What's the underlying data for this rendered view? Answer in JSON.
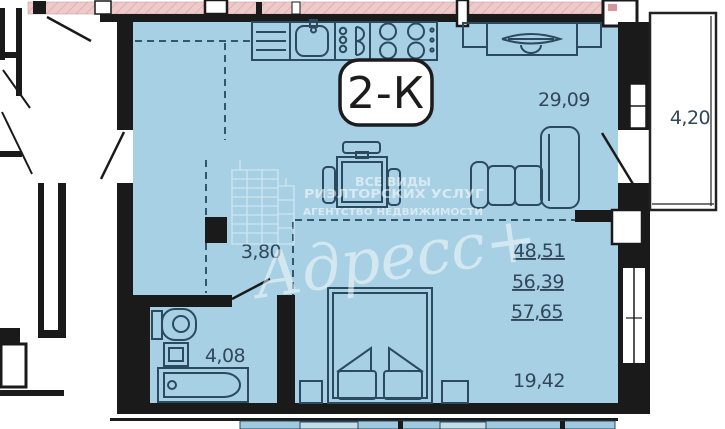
{
  "badge": {
    "label": "2-К"
  },
  "rooms": {
    "kitchen_living": {
      "area": "29,09"
    },
    "balcony": {
      "area": "4,20"
    },
    "hallway": {
      "area": "3,80"
    },
    "bathroom": {
      "area": "4,08"
    },
    "bedroom": {
      "area": "19,42"
    }
  },
  "totals": {
    "line1": "48,51",
    "line2": "56,39",
    "line3": "57,65"
  },
  "watermark": {
    "line1": "ВСЕ ВИДЫ",
    "line2": "РИЭЛТОРСКИХ УСЛУГ",
    "line3": "АГЕНТСТВО НЕДВИЖИМОСТИ",
    "brand": "Адресс+"
  },
  "colors": {
    "floor_fill": "#a7d0e4",
    "wall": "#1a1a1a",
    "neighbor_band": "#eecaca",
    "furniture_line": "#2b4a5e",
    "label_text": "#33475a",
    "watermark": "#ffffff",
    "lower_unit_fill": "#9fc9de"
  }
}
